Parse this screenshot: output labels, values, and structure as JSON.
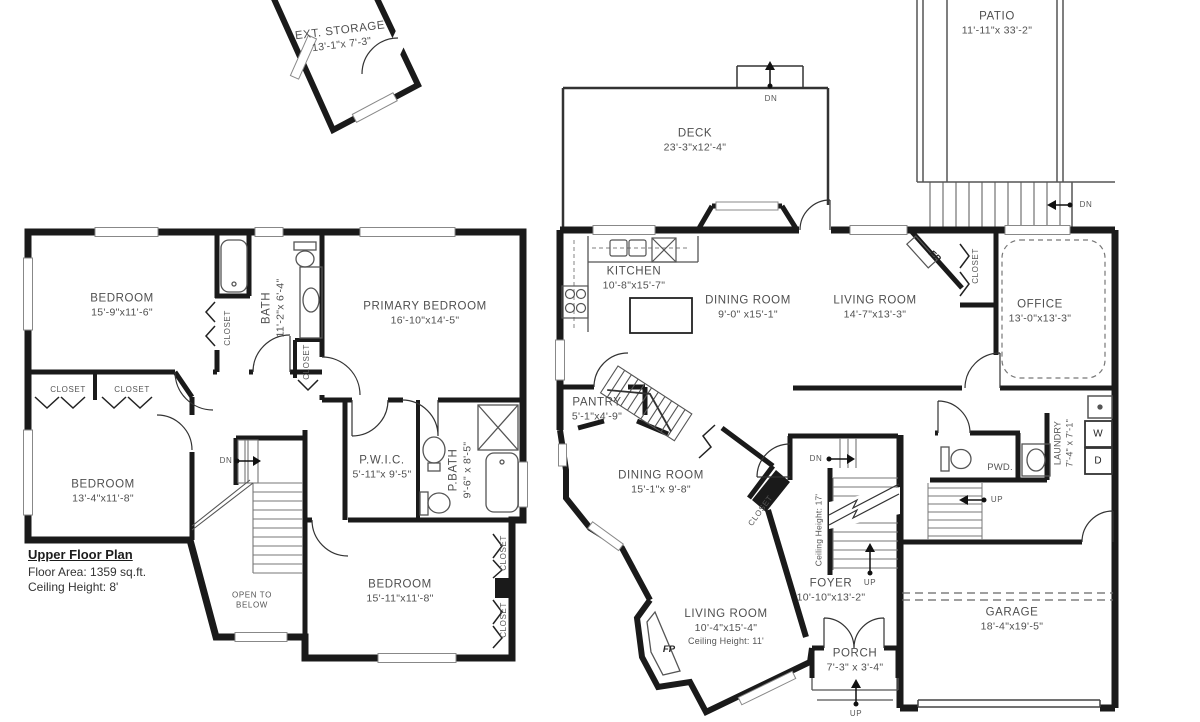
{
  "shared": {
    "closet": "CLOSET",
    "dn": "DN",
    "up": "UP",
    "fp": "FP"
  },
  "upper_floor": {
    "title": "Upper Floor Plan",
    "floor_area": "Floor Area: 1359 sq.ft.",
    "ceiling_height": "Ceiling Height: 8'",
    "open_to_below_line1": "OPEN TO",
    "open_to_below_line2": "BELOW",
    "rooms": {
      "ext_storage": {
        "name": "EXT. STORAGE",
        "dims": "13'-1\"x 7'-3\""
      },
      "bedroom_front": {
        "name": "BEDROOM",
        "dims": "15'-9\"x11'-6\""
      },
      "bath": {
        "name": "BATH",
        "dims": "11'-2\"x 6'-4\""
      },
      "primary_bedroom": {
        "name": "PRIMARY BEDROOM",
        "dims": "16'-10\"x14'-5\""
      },
      "bedroom_left": {
        "name": "BEDROOM",
        "dims": "13'-4\"x11'-8\""
      },
      "pwic": {
        "name": "P.W.I.C.",
        "dims": "5'-11\"x 9'-5\""
      },
      "pbath": {
        "name": "P.BATH",
        "dims": "9'-6\" x 8'-5\""
      },
      "bedroom_rear": {
        "name": "BEDROOM",
        "dims": "15'-11\"x11'-8\""
      }
    }
  },
  "main_floor": {
    "stair_ceiling_note": "Ceiling Height: 17'",
    "rooms": {
      "patio": {
        "name": "PATIO",
        "dims": "11'-11\"x 33'-2\""
      },
      "deck": {
        "name": "DECK",
        "dims": "23'-3\"x12'-4\""
      },
      "kitchen": {
        "name": "KITCHEN",
        "dims": "10'-8\"x15'-7\""
      },
      "dining_room": {
        "name": "DINING ROOM",
        "dims": "9'-0\" x15'-1\""
      },
      "living_room": {
        "name": "LIVING ROOM",
        "dims": "14'-7\"x13'-3\""
      },
      "office": {
        "name": "OFFICE",
        "dims": "13'-0\"x13'-3\""
      },
      "pantry": {
        "name": "PANTRY",
        "dims": "5'-1\"x4'-9\""
      },
      "dining_room_lower": {
        "name": "DINING ROOM",
        "dims": "15'-1\"x 9'-8\""
      },
      "living_room_lower": {
        "name": "LIVING ROOM",
        "dims": "10'-4\"x15'-4\"",
        "note": "Ceiling Height: 11'"
      },
      "foyer": {
        "name": "FOYER",
        "dims": "10'-10\"x13'-2\""
      },
      "porch": {
        "name": "PORCH",
        "dims": "7'-3\" x 3'-4\""
      },
      "garage": {
        "name": "GARAGE",
        "dims": "18'-4\"x19'-5\""
      },
      "powder": {
        "name": "PWD."
      },
      "laundry": {
        "name": "LAUNDRY",
        "dims": "7'-4\" x 7'-1\""
      },
      "washer": "W",
      "dryer": "D"
    }
  }
}
